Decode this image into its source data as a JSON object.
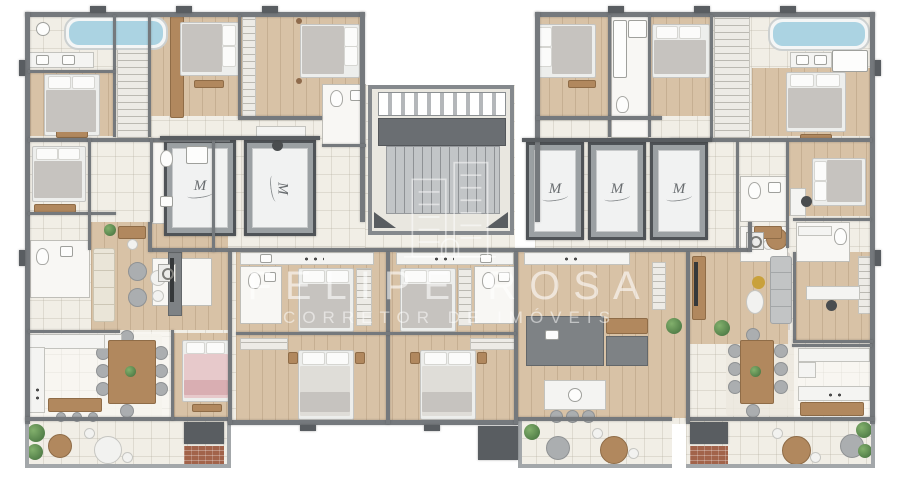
{
  "watermark": {
    "name": "FELIPE ROSA",
    "subtitle": "CORRETOR DE IMÓVEIS",
    "logo": "building-outline-logo"
  },
  "elevators": [
    {
      "label": "M"
    },
    {
      "label": "M"
    },
    {
      "label": "M"
    },
    {
      "label": "M"
    },
    {
      "label": "M"
    }
  ],
  "colors": {
    "wall": "#75797d",
    "wall_dark": "#595d61",
    "floor_tile": "#f1eee6",
    "floor_wood": "#d8c2a6",
    "bathtub_water": "#abd3e2",
    "plant_green": "#4f7a49",
    "pink_bed": "#e7c9cb",
    "wood_furniture": "#b1885e",
    "watermark_text": "rgba(255,255,255,0.55)"
  }
}
